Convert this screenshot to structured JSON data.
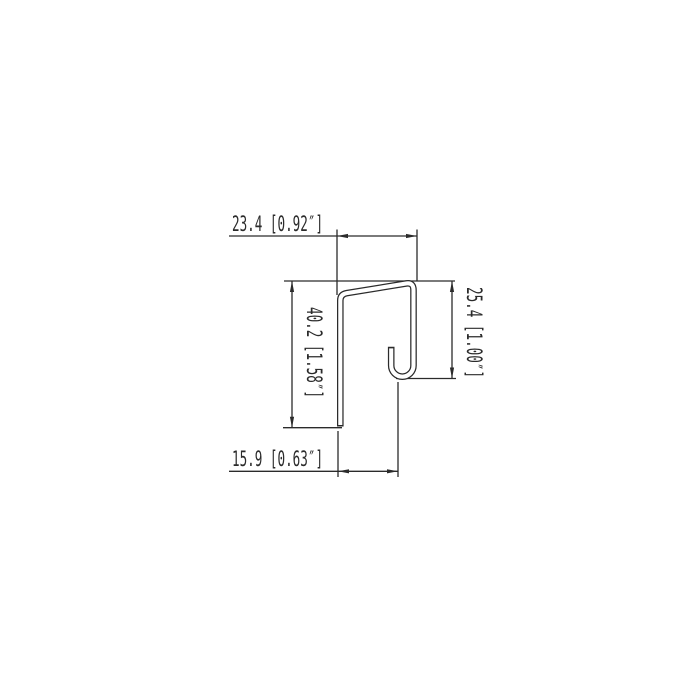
{
  "drawing": {
    "type": "technical-profile-cross-section",
    "background_color": "#ffffff",
    "line_color": "#2b2b2b",
    "dimensions": {
      "top_width": {
        "label": "23.4 [0.92″]",
        "mm": "23.4",
        "inches": "0.92″"
      },
      "left_height": {
        "label": "40.2 [1.58″]",
        "mm": "40.2",
        "inches": "1.58″"
      },
      "right_height": {
        "label": "25.4 [1.00″]",
        "mm": "25.4",
        "inches": "1.00″"
      },
      "bottom_width": {
        "label": "15.9 [0.63″]",
        "mm": "15.9",
        "inches": "0.63″"
      }
    }
  }
}
